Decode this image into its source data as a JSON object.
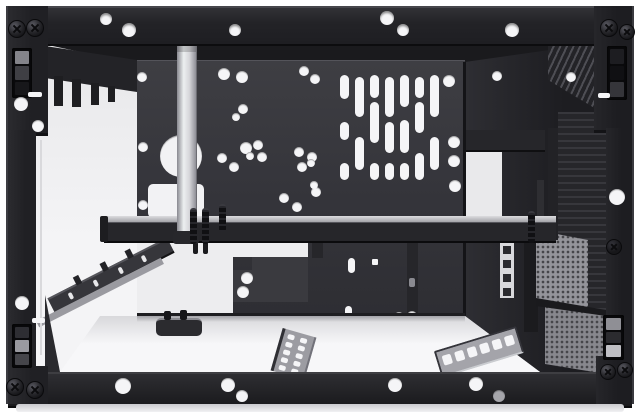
{
  "meta": {
    "description": "Black steel computer case chassis frame, front view with open interior"
  },
  "colors": {
    "frame": "#232327",
    "frameHi": "#47474c",
    "frameDk": "#0c0c0e",
    "panel": "#36363b",
    "panelEdge": "#54545a",
    "white": "#f5f5f7",
    "floor": "#efeff1",
    "silver": "#e3e3e7",
    "silverEdge": "#8f8f96",
    "wall": "#28282c",
    "ink": "#101013",
    "perf": "#94949a",
    "perfDot": "#46464a",
    "greyHole": "#a6a6ab"
  },
  "top_rail": {
    "holes": [
      [
        106,
        19,
        6
      ],
      [
        129,
        30,
        7
      ],
      [
        235,
        30,
        6
      ],
      [
        387,
        18,
        7
      ],
      [
        403,
        30,
        6
      ],
      [
        512,
        30,
        7
      ]
    ]
  },
  "bottom_rail": {
    "holes": [
      [
        123,
        386,
        8
      ],
      [
        228,
        385,
        7
      ],
      [
        242,
        396,
        6
      ],
      [
        395,
        385,
        7
      ],
      [
        476,
        384,
        7
      ]
    ],
    "grey_hole": [
      499,
      396,
      6
    ]
  },
  "left_column": {
    "screws": [
      [
        16,
        28,
        8
      ],
      [
        34,
        27,
        8
      ],
      [
        14,
        386,
        8
      ],
      [
        34,
        389,
        8
      ]
    ],
    "holes": [
      [
        21,
        104,
        7
      ],
      [
        38,
        126,
        6
      ],
      [
        22,
        303,
        7
      ]
    ],
    "slits": [
      [
        28,
        92,
        14,
        5
      ],
      [
        32,
        318,
        13,
        5
      ]
    ],
    "latch_top": {
      "x": 12,
      "y": 48,
      "w": 20,
      "h": 50,
      "segs": [
        "#84848a",
        "#3f3f44",
        "#17171a"
      ]
    },
    "latch_bottom": {
      "x": 12,
      "y": 324,
      "w": 20,
      "h": 44,
      "segs": [
        "#2e2e33",
        "#9a9aa0",
        "#45454a"
      ]
    }
  },
  "right_column": {
    "screws": [
      [
        608,
        27,
        8
      ],
      [
        626,
        31,
        7
      ],
      [
        607,
        371,
        7
      ],
      [
        624,
        369,
        7
      ]
    ],
    "holes": [
      [
        617,
        197,
        8
      ]
    ],
    "dark_screws": [
      [
        613,
        246,
        7
      ]
    ],
    "slits": [
      [
        598,
        93,
        12,
        5
      ]
    ],
    "latch_top": {
      "x": 607,
      "y": 46,
      "w": 20,
      "h": 54,
      "segs": [
        "#1d1d21",
        "#101013",
        "#35353a"
      ]
    },
    "latch_bottom": {
      "x": 603,
      "y": 315,
      "w": 21,
      "h": 45,
      "segs": [
        "#8f8f95",
        "#2b2b2f",
        "#bfbfc4"
      ]
    }
  },
  "back_panel": {
    "x": 137,
    "y": 60,
    "w": 328,
    "h": 256,
    "holes": [
      [
        142,
        77,
        5
      ],
      [
        224,
        74,
        6
      ],
      [
        242,
        77,
        6
      ],
      [
        304,
        71,
        5
      ],
      [
        315,
        79,
        5
      ],
      [
        236,
        117,
        4
      ],
      [
        243,
        109,
        5
      ],
      [
        143,
        147,
        5
      ],
      [
        222,
        158,
        5
      ],
      [
        234,
        167,
        5
      ],
      [
        246,
        148,
        6
      ],
      [
        250,
        156,
        4
      ],
      [
        258,
        145,
        5
      ],
      [
        262,
        157,
        5
      ],
      [
        299,
        152,
        5
      ],
      [
        312,
        157,
        5
      ],
      [
        302,
        167,
        5
      ],
      [
        311,
        163,
        4
      ],
      [
        143,
        205,
        5
      ],
      [
        284,
        198,
        5
      ],
      [
        297,
        207,
        5
      ],
      [
        316,
        192,
        5
      ],
      [
        314,
        185,
        4
      ],
      [
        449,
        81,
        6
      ],
      [
        454,
        142,
        6
      ],
      [
        454,
        161,
        6
      ],
      [
        455,
        186,
        6
      ]
    ],
    "vents": {
      "w": 9,
      "cols": [
        {
          "x": 340,
          "segs": [
            [
              75,
              24
            ],
            [
              122,
              18
            ],
            [
              163,
              17
            ]
          ]
        },
        {
          "x": 355,
          "segs": [
            [
              77,
              40
            ],
            [
              137,
              33
            ]
          ]
        },
        {
          "x": 370,
          "segs": [
            [
              75,
              23
            ],
            [
              102,
              41
            ],
            [
              163,
              17
            ]
          ]
        },
        {
          "x": 385,
          "segs": [
            [
              77,
              40
            ],
            [
              122,
              31
            ],
            [
              163,
              17
            ]
          ]
        },
        {
          "x": 400,
          "segs": [
            [
              75,
              32
            ],
            [
              120,
              33
            ],
            [
              163,
              17
            ]
          ]
        },
        {
          "x": 415,
          "segs": [
            [
              77,
              21
            ],
            [
              102,
              31
            ],
            [
              153,
              27
            ]
          ]
        },
        {
          "x": 430,
          "segs": [
            [
              75,
              42
            ],
            [
              137,
              33
            ]
          ]
        }
      ]
    },
    "big_hole": [
      181,
      156,
      21
    ],
    "cutout": [
      148,
      184,
      56,
      34
    ],
    "opening": [
      137,
      242,
      96,
      74
    ],
    "step_notch": [
      233,
      243,
      75,
      14
    ],
    "l_panel": {
      "rect": [
        233,
        257,
        75,
        45
      ],
      "notch": [
        19,
        13
      ],
      "holes": [
        [
          247,
          278,
          6
        ],
        [
          243,
          292,
          6
        ]
      ]
    },
    "hang_bracket": [
      407,
      241,
      11,
      89
    ],
    "hang_slot": [
      409,
      278,
      6,
      9
    ],
    "tab_mid": [
      312,
      240,
      11,
      18
    ],
    "cap1": [
      348,
      258,
      7,
      15
    ],
    "sq1": [
      372,
      259,
      6,
      6
    ],
    "cap2": [
      345,
      306,
      7,
      17
    ],
    "bot_holes": [
      [
        399,
        317,
        5
      ],
      [
        412,
        316,
        5
      ]
    ],
    "bot_tabs": [
      [
        333,
        314,
        12,
        11
      ],
      [
        417,
        326,
        11,
        9
      ]
    ]
  },
  "right_wall": {
    "poly": "465,62 606,42 606,372 540,372 465,316",
    "rib_top_poly": "548,42 606,42 606,115 548,80",
    "ribs": [
      558,
      112,
      48,
      218
    ],
    "holes": [
      [
        497,
        76,
        5
      ],
      [
        571,
        77,
        5
      ]
    ],
    "white_gap_poly": "466,148 502,140 502,240 466,236",
    "bar_above": [
      465,
      130,
      80,
      20
    ],
    "divider": [
      524,
      228,
      14,
      104
    ],
    "cage_strip": {
      "rect": [
        500,
        240,
        14,
        58
      ],
      "sq_x": 503,
      "sq": 8,
      "squares_y": [
        246,
        260,
        274,
        288
      ]
    },
    "perf1_poly": "536,230 588,240 588,312 536,300",
    "perf2_poly": "545,300 606,312 606,374 545,364",
    "divider2_poly": "536,298 606,310 606,316 536,306",
    "post": [
      548,
      128,
      10,
      112
    ],
    "bracket2": [
      537,
      180,
      7,
      52
    ]
  },
  "left_wall": {
    "bracket_poly": "45,46 137,60 137,92 45,78",
    "tabs": [
      [
        54,
        76,
        9,
        30
      ],
      [
        72,
        79,
        9,
        28
      ],
      [
        91,
        83,
        8,
        22
      ],
      [
        108,
        86,
        7,
        16
      ]
    ],
    "rail1": {
      "cx": 111,
      "cy": 273,
      "len": 134,
      "h": 13,
      "rot": -27,
      "slits": [
        [
          20,
          3,
          4,
          7
        ],
        [
          48,
          3,
          4,
          7
        ],
        [
          76,
          3,
          4,
          7
        ],
        [
          102,
          3,
          4,
          7
        ]
      ],
      "tabs": [
        [
          32,
          6,
          9
        ],
        [
          62,
          6,
          9
        ],
        [
          90,
          6,
          9
        ]
      ]
    },
    "rail2": {
      "cx": 100,
      "cy": 292,
      "len": 140,
      "h": 7,
      "rot": -27
    },
    "corner_poly": "45,295 60,372 45,372",
    "fitting": {
      "bar": [
        156,
        318,
        46,
        16
      ],
      "bumps": [
        [
          164,
          311,
          7,
          9
        ],
        [
          180,
          310,
          7,
          10
        ]
      ]
    },
    "edge_line": [
      40,
      140,
      2,
      215
    ]
  },
  "floor": {
    "grad_poly": "100,316 465,316 540,372 60,372",
    "stripA": {
      "x": 276,
      "y": 332,
      "w": 30,
      "h": 44,
      "rot": 16,
      "cols": 2,
      "rows": 5
    },
    "stripB": {
      "x": 436,
      "y": 338,
      "w": 82,
      "h": 24,
      "rot": -17,
      "n": 6
    }
  },
  "tray": {
    "x": 104,
    "y": 216,
    "w": 452,
    "lip_h": 6,
    "face_h": 18,
    "standoffs": [
      [
        190,
        208,
        7,
        34
      ],
      [
        202,
        208,
        7,
        34
      ],
      [
        219,
        204,
        7,
        26
      ],
      [
        528,
        211,
        7,
        30
      ]
    ],
    "pegs": [
      [
        193,
        242,
        5,
        12
      ],
      [
        203,
        242,
        5,
        12
      ]
    ]
  },
  "silver_rail": {
    "x": 177,
    "y": 42,
    "w": 19,
    "h": 192,
    "foot": [
      173,
      231,
      26,
      13
    ]
  }
}
